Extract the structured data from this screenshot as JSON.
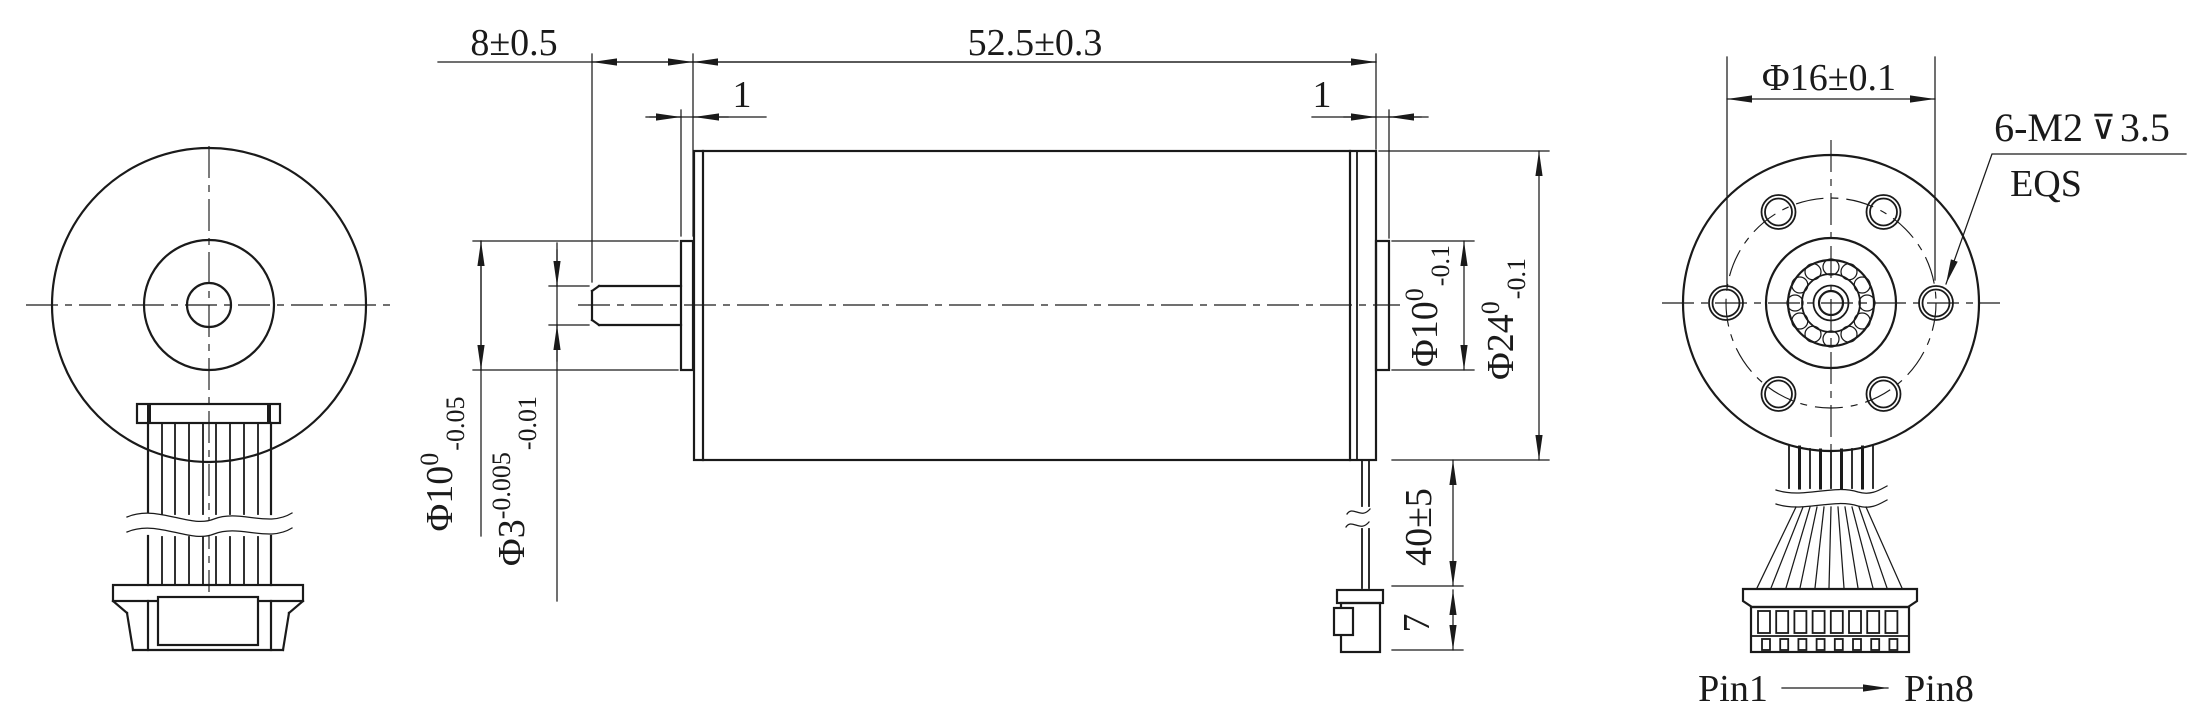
{
  "drawing": {
    "line_color": "#1a1a1a",
    "background": "#ffffff",
    "dimensions": {
      "shaft_length": "8±0.5",
      "body_length": "52.5±0.3",
      "front_pilot_width": "1",
      "rear_pilot_width": "1",
      "front_hub_dia": {
        "nominal": "Φ10",
        "upper": "0",
        "lower": "-0.05"
      },
      "shaft_dia": {
        "nominal": "Φ3",
        "upper": "-0.005",
        "lower": "-0.01"
      },
      "rear_hub_dia": {
        "nominal": "Φ10",
        "upper": "0",
        "lower": "-0.1"
      },
      "body_dia": {
        "nominal": "Φ24",
        "upper": "0",
        "lower": "-0.1"
      },
      "lead_wire_length": "40±5",
      "connector_height": "7",
      "bolt_circle_dia": "Φ16±0.1"
    },
    "notes": {
      "tapped_holes": {
        "label": "6-M2",
        "depth_symbol": "⊽",
        "depth": "3.5",
        "spacing": "EQS"
      }
    },
    "pins": {
      "first": "Pin1",
      "last": "Pin8"
    }
  }
}
